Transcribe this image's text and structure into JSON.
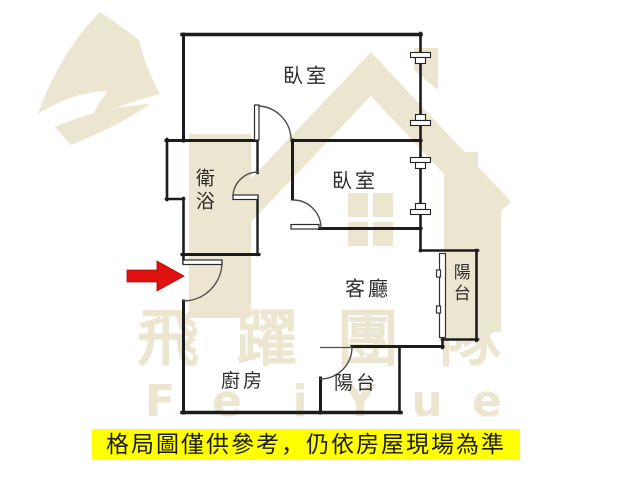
{
  "watermark": {
    "color": "#ece5cf",
    "brand_chars": [
      "飛",
      "躍",
      "團",
      "隊"
    ],
    "latin_chars": [
      "F",
      "e",
      "i",
      "Y",
      "u",
      "e"
    ]
  },
  "rooms": {
    "bedroom_top": "臥室",
    "bathroom": "衛浴",
    "bedroom_2": "臥室",
    "living_room": "客廳",
    "balcony_right": "陽台",
    "kitchen": "廚房",
    "balcony_bottom": "陽台"
  },
  "entrance": {
    "arrow_color": "#e01111"
  },
  "disclaimer": {
    "text": "格局圖僅供參考，仍依房屋現場為準",
    "background": "#ffff00",
    "text_color": "#1b1b1b"
  }
}
